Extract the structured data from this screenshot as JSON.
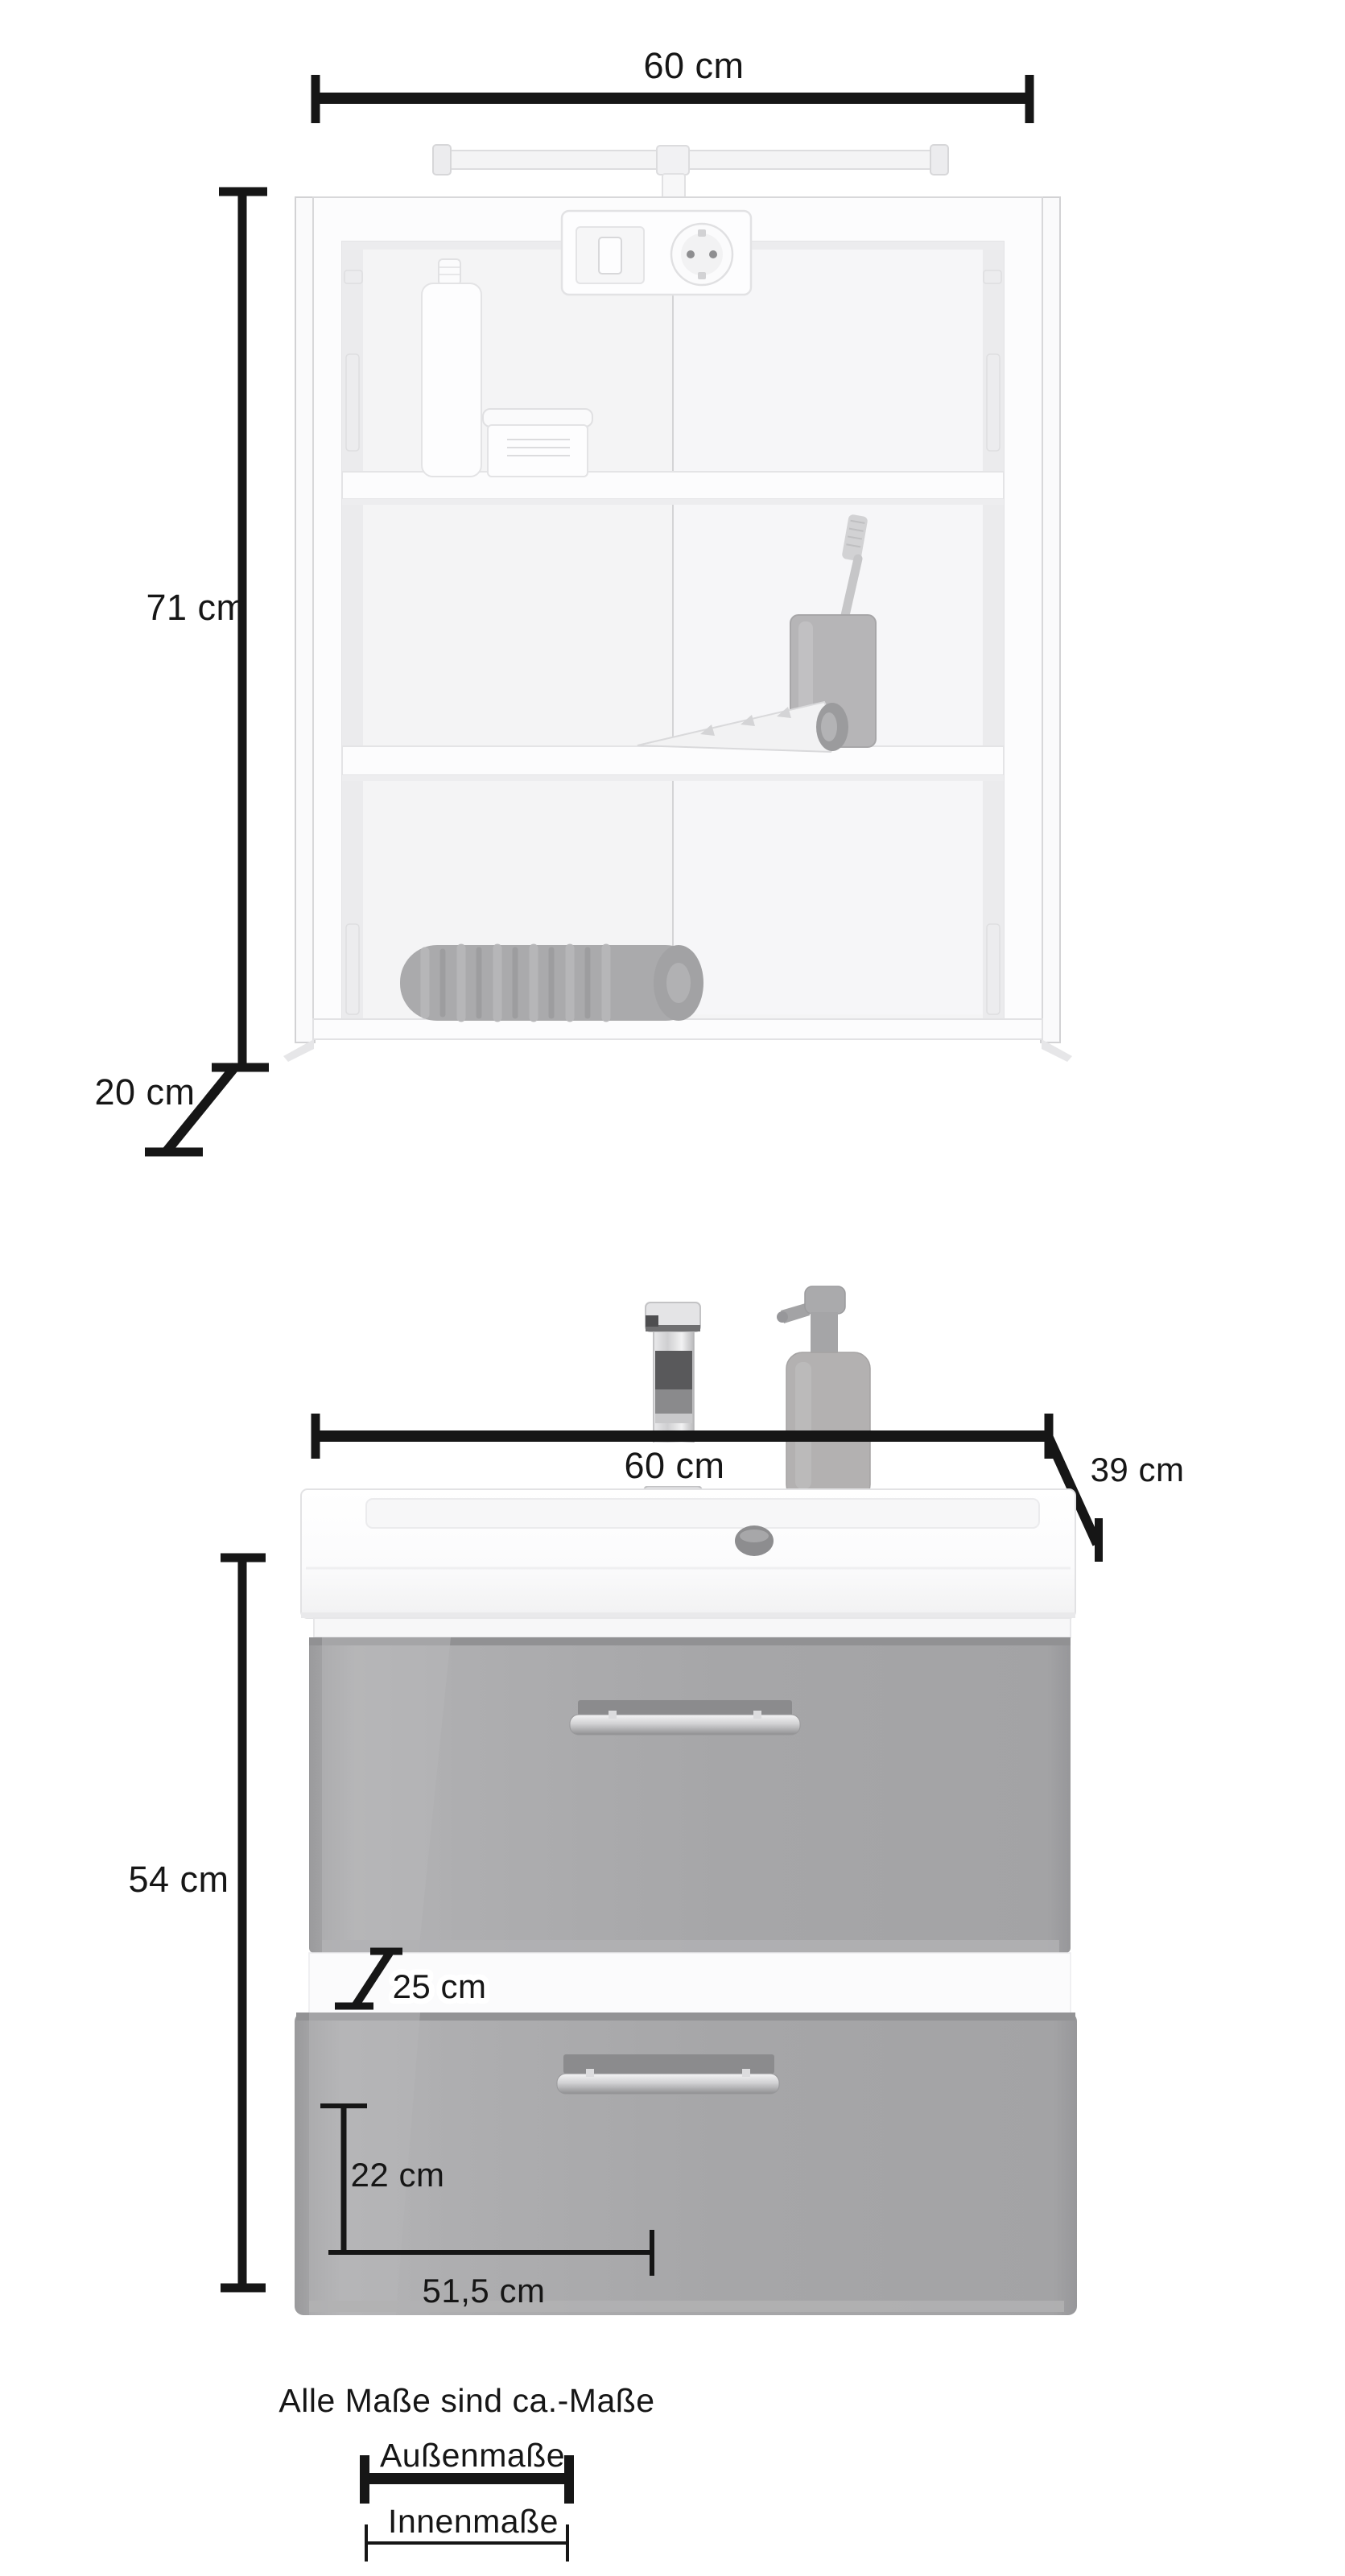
{
  "diagram": {
    "title_hint": "bathroom furniture dimension diagram",
    "upper_cabinet": {
      "width_label": "60 cm",
      "height_label": "71 cm",
      "depth_label": "20 cm"
    },
    "vanity": {
      "width_label": "60 cm",
      "depth_label": "39 cm",
      "height_label": "54 cm",
      "drawer_front_label": "25 cm",
      "inner_height_label": "22 cm",
      "inner_width_label": "51,5 cm"
    },
    "legend": {
      "note": "Alle Maße sind ca.-Maße",
      "outer_label": "Außenmaße",
      "inner_label": "Innenmaße"
    },
    "colors": {
      "dimension_ink": "#161616",
      "furniture_white": "#fcfcfd",
      "interior_white": "#f4f4f5",
      "drawer_gray": "#a7a7a9",
      "towel_gray": "#aaaaac",
      "chrome": "#d9d9db"
    }
  }
}
